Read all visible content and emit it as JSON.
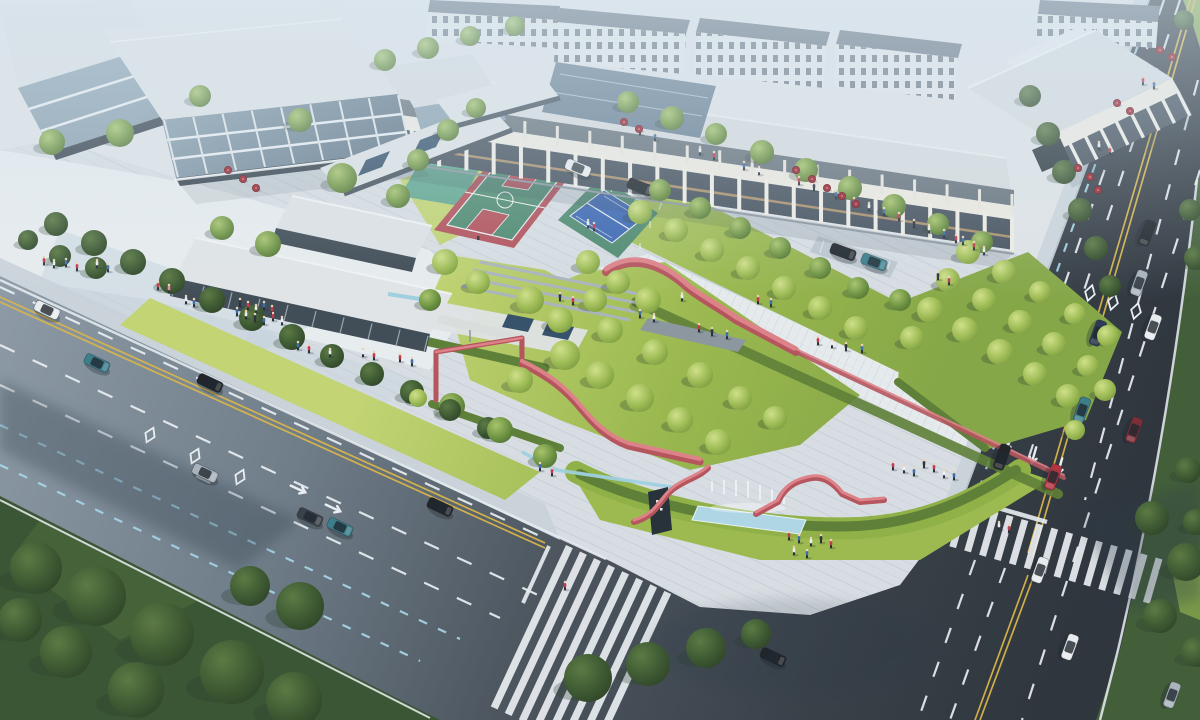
{
  "scene": {
    "width": 1200,
    "height": 720
  },
  "palette": {
    "bg": "#dfe3e6",
    "plaza": "#d7dde2",
    "plazaLight": "#e9edf0",
    "plazaBlue": "#c3d1dc",
    "sidewalk": "#c9d1d8",
    "roadA": "#8e9ba7",
    "roadB": "#707e8a",
    "roadC": "#4d565f",
    "roadD": "#2f363e",
    "laneWhite": "#e9eef2",
    "laneYellow": "#d9b54a",
    "laneBlue": "#a8d8ea",
    "zebra": "#e9eef1",
    "lawnA": "#c2d474",
    "lawnB": "#9ab84f",
    "lawnC": "#86a748",
    "grassDark": "#3b5634",
    "grassMid": "#435f3a",
    "hedge": "#8fb148",
    "hedgeDark": "#5f8038",
    "courtRed": "#b2525b",
    "courtGreen": "#4f8a70",
    "courtBlue": "#3c67b1",
    "courtTeal": "#5aa392",
    "ribbon": "#c05f68",
    "ribbonDark": "#b5555e",
    "ribbonLight": "#dd8289",
    "water": "#aed6e4",
    "runnel": "#9fd0e0",
    "glassDark": "#47535f",
    "glassMid": "#8ba0af",
    "roofLight": "#d6dbde",
    "cream": "#ece9e0",
    "beamTan": "#a98f6c",
    "residentialRoof": "#6b7683",
    "windowDark": "#5a6771",
    "signDark": "#27323a",
    "umbrella": "#9c232e",
    "umbrellaDark": "#6f161f",
    "skinTone": "#ecd2b4",
    "shadow": "#2f3e4a",
    "haze": "#d6e6f2"
  },
  "car_colors": {
    "white": "#e8ebee",
    "black": "#22262b",
    "teal": "#3d7e8c",
    "silver": "#aab3bb",
    "navy": "#2c3a55",
    "red": "#b03540",
    "darkred": "#7c2f38",
    "gray": "#6d767e",
    "darkgray": "#3a4148"
  },
  "person_colors": {
    "r": "#c23b4e",
    "w": "#eceef0",
    "b": "#3f6ea8",
    "d": "#2d3642",
    "p": "#e08aa0"
  },
  "buildings": {
    "arcade_columns": 26,
    "arcade_upper_columns": 22,
    "right_building_columns": 9,
    "pavilion_mullions": 10,
    "tl_building_columns": 9
  },
  "trees": [
    [
      52,
      142,
      13,
      "M"
    ],
    [
      120,
      133,
      14,
      "M"
    ],
    [
      200,
      96,
      11,
      "M"
    ],
    [
      300,
      120,
      12,
      "M"
    ],
    [
      342,
      178,
      15,
      "M"
    ],
    [
      385,
      60,
      11,
      "M"
    ],
    [
      428,
      48,
      11,
      "M"
    ],
    [
      470,
      36,
      10,
      "M"
    ],
    [
      515,
      26,
      10,
      "M"
    ],
    [
      222,
      228,
      12,
      "M"
    ],
    [
      268,
      244,
      13,
      "M"
    ],
    [
      60,
      256,
      11,
      "D"
    ],
    [
      28,
      240,
      10,
      "D"
    ],
    [
      96,
      268,
      11,
      "D"
    ],
    [
      56,
      224,
      12,
      "D"
    ],
    [
      94,
      243,
      13,
      "D"
    ],
    [
      133,
      262,
      13,
      "D"
    ],
    [
      172,
      281,
      13,
      "D"
    ],
    [
      212,
      300,
      13,
      "D"
    ],
    [
      252,
      318,
      13,
      "D"
    ],
    [
      292,
      337,
      13,
      "D"
    ],
    [
      332,
      356,
      12,
      "D"
    ],
    [
      372,
      374,
      12,
      "D"
    ],
    [
      412,
      392,
      12,
      "D"
    ],
    [
      450,
      410,
      11,
      "D"
    ],
    [
      488,
      428,
      11,
      "D"
    ],
    [
      452,
      406,
      13,
      "M"
    ],
    [
      500,
      430,
      13,
      "M"
    ],
    [
      545,
      456,
      12,
      "M"
    ],
    [
      418,
      398,
      9,
      "L"
    ],
    [
      398,
      196,
      12,
      "M"
    ],
    [
      418,
      160,
      11,
      "M"
    ],
    [
      448,
      130,
      11,
      "M"
    ],
    [
      476,
      108,
      10,
      "M"
    ],
    [
      445,
      262,
      13,
      "L"
    ],
    [
      478,
      282,
      12,
      "L"
    ],
    [
      430,
      300,
      11,
      "M"
    ],
    [
      530,
      300,
      14,
      "L"
    ],
    [
      560,
      320,
      13,
      "L"
    ],
    [
      588,
      262,
      12,
      "L"
    ],
    [
      618,
      282,
      12,
      "L"
    ],
    [
      648,
      300,
      13,
      "L"
    ],
    [
      565,
      355,
      15,
      "L"
    ],
    [
      600,
      375,
      14,
      "L"
    ],
    [
      640,
      398,
      14,
      "L"
    ],
    [
      680,
      420,
      13,
      "L"
    ],
    [
      718,
      442,
      13,
      "L"
    ],
    [
      520,
      380,
      13,
      "L"
    ],
    [
      610,
      330,
      13,
      "L"
    ],
    [
      655,
      352,
      13,
      "L"
    ],
    [
      700,
      375,
      13,
      "L"
    ],
    [
      740,
      398,
      12,
      "L"
    ],
    [
      775,
      418,
      12,
      "L"
    ],
    [
      595,
      300,
      12,
      "L"
    ],
    [
      640,
      212,
      12,
      "L"
    ],
    [
      676,
      230,
      12,
      "L"
    ],
    [
      712,
      250,
      12,
      "L"
    ],
    [
      748,
      268,
      12,
      "L"
    ],
    [
      784,
      288,
      12,
      "L"
    ],
    [
      820,
      308,
      12,
      "L"
    ],
    [
      856,
      328,
      12,
      "L"
    ],
    [
      660,
      190,
      11,
      "M"
    ],
    [
      700,
      208,
      11,
      "M"
    ],
    [
      740,
      228,
      11,
      "M"
    ],
    [
      780,
      248,
      11,
      "M"
    ],
    [
      820,
      268,
      11,
      "M"
    ],
    [
      858,
      288,
      11,
      "M"
    ],
    [
      930,
      310,
      13,
      "L"
    ],
    [
      965,
      330,
      13,
      "L"
    ],
    [
      1000,
      352,
      13,
      "L"
    ],
    [
      1035,
      374,
      12,
      "L"
    ],
    [
      1068,
      396,
      12,
      "L"
    ],
    [
      948,
      280,
      12,
      "L"
    ],
    [
      984,
      300,
      12,
      "L"
    ],
    [
      1020,
      322,
      12,
      "L"
    ],
    [
      1054,
      344,
      12,
      "L"
    ],
    [
      1088,
      366,
      11,
      "L"
    ],
    [
      968,
      252,
      12,
      "L"
    ],
    [
      1004,
      272,
      12,
      "L"
    ],
    [
      1040,
      292,
      11,
      "L"
    ],
    [
      1075,
      314,
      11,
      "L"
    ],
    [
      1108,
      336,
      11,
      "L"
    ],
    [
      912,
      338,
      12,
      "L"
    ],
    [
      900,
      300,
      11,
      "M"
    ],
    [
      1105,
      390,
      11,
      "L"
    ],
    [
      1075,
      430,
      10,
      "L"
    ],
    [
      628,
      102,
      11,
      "M"
    ],
    [
      672,
      118,
      12,
      "M"
    ],
    [
      716,
      134,
      11,
      "M"
    ],
    [
      762,
      152,
      12,
      "M"
    ],
    [
      806,
      170,
      12,
      "M"
    ],
    [
      850,
      188,
      12,
      "M"
    ],
    [
      894,
      206,
      12,
      "M"
    ],
    [
      938,
      224,
      11,
      "M"
    ],
    [
      982,
      242,
      11,
      "M"
    ],
    [
      1030,
      96,
      11,
      "D"
    ],
    [
      1048,
      134,
      12,
      "D"
    ],
    [
      1064,
      172,
      12,
      "D"
    ],
    [
      1080,
      210,
      12,
      "D"
    ],
    [
      1096,
      248,
      12,
      "D"
    ],
    [
      1110,
      286,
      11,
      "D"
    ],
    [
      1190,
      210,
      11,
      "D"
    ],
    [
      1196,
      258,
      12,
      "D"
    ],
    [
      1188,
      470,
      13,
      "D"
    ],
    [
      1196,
      522,
      13,
      "D"
    ],
    [
      1152,
      518,
      17,
      "D"
    ],
    [
      1186,
      562,
      19,
      "D"
    ],
    [
      1160,
      616,
      17,
      "D"
    ],
    [
      1196,
      652,
      15,
      "D"
    ],
    [
      588,
      678,
      24,
      "D"
    ],
    [
      648,
      664,
      22,
      "D"
    ],
    [
      706,
      648,
      20,
      "D"
    ],
    [
      756,
      634,
      15,
      "D"
    ],
    [
      36,
      568,
      26,
      "D"
    ],
    [
      96,
      596,
      30,
      "D"
    ],
    [
      162,
      634,
      32,
      "D"
    ],
    [
      232,
      672,
      32,
      "D"
    ],
    [
      66,
      652,
      26,
      "D"
    ],
    [
      136,
      690,
      28,
      "D"
    ],
    [
      294,
      700,
      28,
      "D"
    ],
    [
      300,
      606,
      24,
      "D"
    ],
    [
      20,
      620,
      22,
      "D"
    ],
    [
      250,
      586,
      20,
      "D"
    ],
    [
      1184,
      20,
      10,
      "D"
    ]
  ],
  "cars": [
    [
      47,
      310,
      25,
      "white"
    ],
    [
      97,
      363,
      25,
      "teal"
    ],
    [
      210,
      383,
      25,
      "black"
    ],
    [
      205,
      473,
      25,
      "silver"
    ],
    [
      310,
      517,
      25,
      "darkgray"
    ],
    [
      340,
      527,
      25,
      "teal"
    ],
    [
      440,
      507,
      25,
      "black"
    ],
    [
      1147,
      233,
      110,
      "black"
    ],
    [
      1139,
      283,
      110,
      "silver"
    ],
    [
      1153,
      327,
      110,
      "white"
    ],
    [
      1098,
      333,
      110,
      "navy"
    ],
    [
      1082,
      410,
      110,
      "teal"
    ],
    [
      1134,
      430,
      110,
      "darkred"
    ],
    [
      1053,
      477,
      110,
      "red"
    ],
    [
      1002,
      457,
      110,
      "black"
    ],
    [
      1040,
      570,
      110,
      "white"
    ],
    [
      1070,
      647,
      110,
      "white"
    ],
    [
      1172,
      695,
      110,
      "silver"
    ],
    [
      773,
      657,
      25,
      "black"
    ],
    [
      578,
      168,
      22,
      "white"
    ],
    [
      640,
      187,
      22,
      "black"
    ],
    [
      843,
      252,
      20,
      "black"
    ],
    [
      874,
      262,
      20,
      "teal"
    ]
  ],
  "people": [
    [
      44,
      264,
      "r"
    ],
    [
      54,
      267,
      "w"
    ],
    [
      66,
      266,
      "b"
    ],
    [
      77,
      270,
      "r"
    ],
    [
      97,
      267,
      "w"
    ],
    [
      108,
      271,
      "b"
    ],
    [
      158,
      289,
      "r"
    ],
    [
      169,
      292,
      "p"
    ],
    [
      240,
      306,
      "d"
    ],
    [
      248,
      309,
      "r"
    ],
    [
      256,
      312,
      "w"
    ],
    [
      264,
      309,
      "b"
    ],
    [
      272,
      313,
      "r"
    ],
    [
      246,
      318,
      "w"
    ],
    [
      255,
      321,
      "d"
    ],
    [
      264,
      324,
      "b"
    ],
    [
      273,
      320,
      "r"
    ],
    [
      282,
      324,
      "w"
    ],
    [
      237,
      315,
      "b"
    ],
    [
      363,
      356,
      "w"
    ],
    [
      374,
      359,
      "r"
    ],
    [
      298,
      349,
      "b"
    ],
    [
      309,
      352,
      "r"
    ],
    [
      330,
      356,
      "w"
    ],
    [
      400,
      361,
      "r"
    ],
    [
      412,
      365,
      "b"
    ],
    [
      560,
      300,
      "d"
    ],
    [
      573,
      304,
      "r"
    ],
    [
      640,
      317,
      "b"
    ],
    [
      654,
      321,
      "w"
    ],
    [
      699,
      331,
      "r"
    ],
    [
      712,
      335,
      "d"
    ],
    [
      727,
      338,
      "b"
    ],
    [
      682,
      300,
      "w"
    ],
    [
      758,
      303,
      "r"
    ],
    [
      771,
      306,
      "b"
    ],
    [
      818,
      344,
      "r"
    ],
    [
      832,
      347,
      "w"
    ],
    [
      846,
      350,
      "d"
    ],
    [
      862,
      352,
      "b"
    ],
    [
      640,
      134,
      "r"
    ],
    [
      655,
      140,
      "b"
    ],
    [
      700,
      154,
      "w"
    ],
    [
      714,
      159,
      "r"
    ],
    [
      744,
      169,
      "b"
    ],
    [
      759,
      174,
      "w"
    ],
    [
      799,
      184,
      "r"
    ],
    [
      814,
      190,
      "d"
    ],
    [
      836,
      198,
      "b"
    ],
    [
      854,
      205,
      "r"
    ],
    [
      869,
      210,
      "w"
    ],
    [
      884,
      215,
      "b"
    ],
    [
      899,
      220,
      "r"
    ],
    [
      914,
      227,
      "d"
    ],
    [
      929,
      232,
      "w"
    ],
    [
      944,
      237,
      "b"
    ],
    [
      956,
      242,
      "r"
    ],
    [
      789,
      539,
      "r"
    ],
    [
      799,
      542,
      "b"
    ],
    [
      811,
      545,
      "w"
    ],
    [
      821,
      542,
      "d"
    ],
    [
      831,
      547,
      "r"
    ],
    [
      794,
      554,
      "w"
    ],
    [
      807,
      557,
      "b"
    ],
    [
      893,
      469,
      "r"
    ],
    [
      904,
      472,
      "w"
    ],
    [
      914,
      475,
      "b"
    ],
    [
      924,
      467,
      "d"
    ],
    [
      934,
      471,
      "r"
    ],
    [
      944,
      477,
      "w"
    ],
    [
      954,
      479,
      "b"
    ],
    [
      1143,
      84,
      "r"
    ],
    [
      1154,
      88,
      "b"
    ],
    [
      1099,
      149,
      "w"
    ],
    [
      1110,
      154,
      "r"
    ],
    [
      963,
      244,
      "b"
    ],
    [
      974,
      249,
      "r"
    ],
    [
      984,
      254,
      "w"
    ],
    [
      938,
      279,
      "d"
    ],
    [
      949,
      284,
      "r"
    ],
    [
      588,
      227,
      "w"
    ],
    [
      594,
      230,
      "r"
    ],
    [
      540,
      470,
      "b"
    ],
    [
      552,
      475,
      "r"
    ],
    [
      999,
      529,
      "w"
    ],
    [
      1009,
      532,
      "r"
    ],
    [
      186,
      303,
      "w"
    ],
    [
      194,
      306,
      "b"
    ],
    [
      565,
      589,
      "r"
    ]
  ],
  "umbrellas": [
    [
      228,
      170
    ],
    [
      243,
      179
    ],
    [
      256,
      188
    ],
    [
      624,
      122
    ],
    [
      639,
      129
    ],
    [
      796,
      170
    ],
    [
      812,
      179
    ],
    [
      827,
      188
    ],
    [
      842,
      196
    ],
    [
      856,
      204
    ],
    [
      1160,
      50
    ],
    [
      1172,
      57
    ],
    [
      1117,
      103
    ],
    [
      1130,
      111
    ],
    [
      1078,
      168
    ],
    [
      1090,
      177
    ],
    [
      1098,
      190
    ]
  ]
}
